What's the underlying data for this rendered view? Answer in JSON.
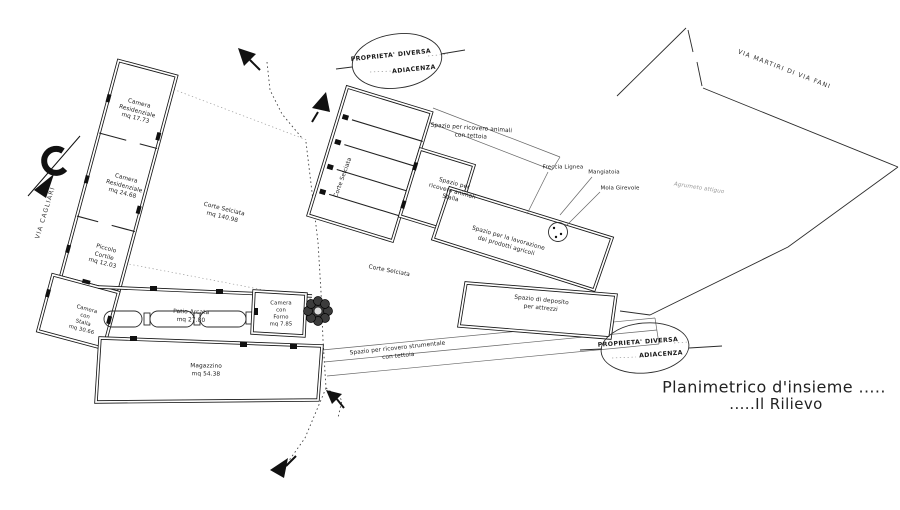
{
  "drawing": {
    "title_line1": "Planimetrico d'insieme .....",
    "title_line2": ".....Il Rilievo"
  },
  "streets": {
    "via_cagliari": "VIA CAGLIARI",
    "via_martiri_di_via_fani": "VIA MARTIRI DI VIA FANI"
  },
  "adjacent_property_note": {
    "line1": "PROPRIETA' DIVERSA",
    "line2": "ADIACENZA"
  },
  "rooms": {
    "camera_residenziale_1": "Camera\nResidenziale\nmq 17.73",
    "camera_residenziale_2": "Camera\nResidenziale\nmq 24.68",
    "piccolo_cortile": "Piccolo\nCortile\nmq 12.03",
    "camera_con_stalla": "Camera\ncon\nStalla\nmq 30.66",
    "corte_selciata_principale": "Corte Selciata\nmq 140.98",
    "patio_arcata": "Patio Arcata\nmq 27.80",
    "camera_con_forno": "Camera\ncon\nForno\nmq 7.85",
    "magazzino": "Magazzino\nmq 54.38",
    "corte_selciata_nord": "Corte Selciata",
    "corte_selciata_centrale": "Corte Selciata",
    "spazio_ricovero_animali_tettoia": "Spazio per ricovero animali\ncon tettoia",
    "spazio_ricovero_animali_stalla": "Spazio per\nricovero animali\nStalla",
    "spazio_lavorazione": "Spazio per la lavorazione\ndei prodotti agricoli",
    "spazio_deposito": "Spazio di deposito\nper attrezzi",
    "spazio_ricovero_strumentale": "Spazio per ricovero strumentale\ncon tettoia"
  },
  "callouts": {
    "freccia_lignea": "Freccia Lignea",
    "mangiatoia": "Mangiatoia",
    "mola_girevole": "Mola Girevole",
    "agrumeto": "Agrumeto attiguo"
  },
  "colors": {
    "ink": "#1a1a1a",
    "paper": "#ffffff",
    "faint": "#9a9a9a"
  }
}
